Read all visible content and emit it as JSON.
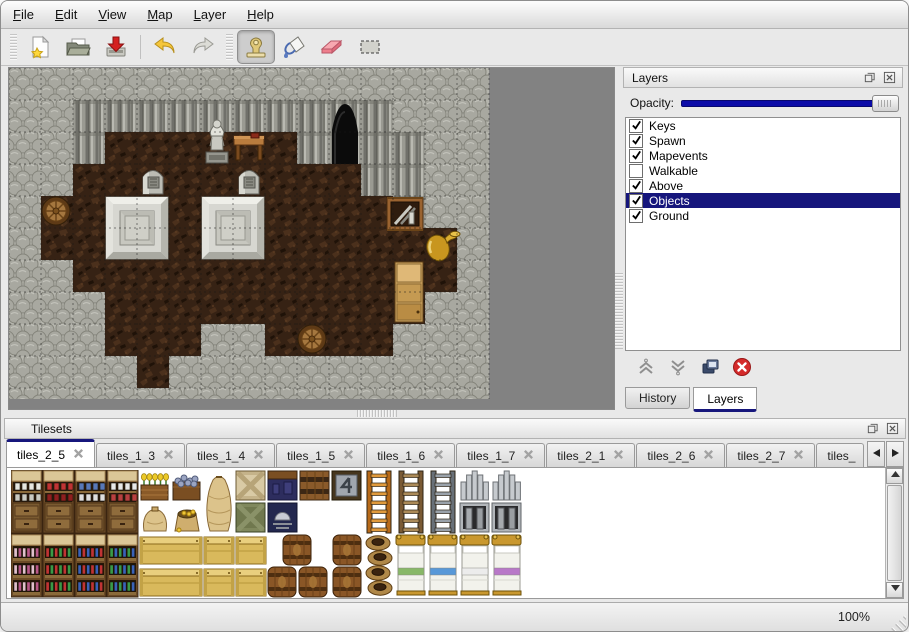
{
  "menubar": {
    "items": [
      {
        "label": "File"
      },
      {
        "label": "Edit"
      },
      {
        "label": "View"
      },
      {
        "label": "Map"
      },
      {
        "label": "Layer"
      },
      {
        "label": "Help"
      }
    ]
  },
  "toolbar": {
    "groups": [
      {
        "buttons": [
          {
            "name": "new",
            "icon": "new-file-icon"
          },
          {
            "name": "open",
            "icon": "open-folder-icon"
          },
          {
            "name": "save",
            "icon": "save-icon"
          }
        ]
      },
      {
        "buttons": [
          {
            "name": "undo",
            "icon": "undo-icon"
          },
          {
            "name": "redo",
            "icon": "redo-icon"
          }
        ]
      },
      {
        "buttons": [
          {
            "name": "stamp-tool",
            "icon": "stamp-icon",
            "selected": true
          },
          {
            "name": "fill-tool",
            "icon": "fill-icon"
          },
          {
            "name": "eraser-tool",
            "icon": "eraser-icon"
          },
          {
            "name": "select-tool",
            "icon": "select-icon"
          }
        ]
      }
    ]
  },
  "map": {
    "tile_size": 32,
    "grid": [
      "RRRRRRRRRRRRRRR",
      "RRWWWWWWWWWWRRR",
      "RRWFFFFFFWWWWRR",
      "RRFFFFFFFFFWWRR",
      "RFFFFFFFFFFFWRR",
      "RFFFFFFFFFFFFFR",
      "RRFFFFFFFFFFFFR",
      "RRRFFFFFFFFFFRR",
      "RRRFFFRRFFFFRRR",
      "RRRRFRRRRRRRRRR",
      "RRRRRRRRRRRRRRR"
    ],
    "objects": [
      {
        "type": "cave-door",
        "col": 10,
        "row": 1
      },
      {
        "type": "statue",
        "col": 6,
        "row": 1
      },
      {
        "type": "table",
        "col": 7,
        "row": 2
      },
      {
        "type": "gravestone",
        "col": 4,
        "row": 3
      },
      {
        "type": "gravestone",
        "col": 7,
        "row": 3
      },
      {
        "type": "pedestal",
        "col": 3,
        "row": 4
      },
      {
        "type": "pedestal",
        "col": 6,
        "row": 4
      },
      {
        "type": "barrel",
        "col": 1,
        "row": 4
      },
      {
        "type": "crate-weapons",
        "col": 12,
        "row": 4,
        "dx": -6
      },
      {
        "type": "gold-jug",
        "col": 13,
        "row": 5
      },
      {
        "type": "cabinet",
        "col": 12,
        "row": 6
      },
      {
        "type": "barrel",
        "col": 9,
        "row": 8
      }
    ]
  },
  "layers_panel": {
    "title": "Layers",
    "opacity_label": "Opacity:",
    "opacity_value": 100,
    "layers": [
      {
        "label": "Keys",
        "checked": true
      },
      {
        "label": "Spawn",
        "checked": true
      },
      {
        "label": "Mapevents",
        "checked": true
      },
      {
        "label": "Walkable",
        "checked": false
      },
      {
        "label": "Above",
        "checked": true
      },
      {
        "label": "Objects",
        "checked": true,
        "selected": true
      },
      {
        "label": "Ground",
        "checked": true
      }
    ],
    "buttons": [
      {
        "name": "raise-layer",
        "icon": "raise-icon"
      },
      {
        "name": "lower-layer",
        "icon": "lower-icon"
      },
      {
        "name": "duplicate-layer",
        "icon": "duplicate-icon"
      },
      {
        "name": "delete-layer",
        "icon": "delete-icon"
      }
    ],
    "tabs": [
      {
        "label": "History",
        "active": false
      },
      {
        "label": "Layers",
        "active": true
      }
    ]
  },
  "tilesets_panel": {
    "title": "Tilesets",
    "tabs": [
      {
        "label": "tiles_2_5",
        "active": true
      },
      {
        "label": "tiles_1_3"
      },
      {
        "label": "tiles_1_4"
      },
      {
        "label": "tiles_1_5"
      },
      {
        "label": "tiles_1_6"
      },
      {
        "label": "tiles_1_7"
      },
      {
        "label": "tiles_2_1"
      },
      {
        "label": "tiles_2_6"
      },
      {
        "label": "tiles_2_7"
      },
      {
        "label": "tiles_",
        "truncated": true
      }
    ],
    "tiles": [
      {
        "kind": "shelf",
        "col": 0,
        "row": 0,
        "accent": "#e6e6e0",
        "accent2": "#c9c9c1"
      },
      {
        "kind": "shelf",
        "col": 1,
        "row": 0,
        "accent": "#c03434",
        "accent2": "#8e1f1f"
      },
      {
        "kind": "shelf",
        "col": 2,
        "row": 0,
        "accent": "#5878b8",
        "accent2": "#dedede"
      },
      {
        "kind": "shelf",
        "col": 3,
        "row": 0,
        "accent": "#e8e8e8",
        "accent2": "#b84040"
      },
      {
        "kind": "bookshelf",
        "col": 0,
        "row": 2,
        "accent": "#e0c0cc",
        "accent2": "#b85888"
      },
      {
        "kind": "bookshelf",
        "col": 1,
        "row": 2,
        "accent": "#c03434",
        "accent2": "#3a9a48"
      },
      {
        "kind": "bookshelf",
        "col": 2,
        "row": 2,
        "accent": "#3a62b8",
        "accent2": "#c03434"
      },
      {
        "kind": "bookshelf",
        "col": 3,
        "row": 2,
        "accent": "#3a9a48",
        "accent2": "#3a62b8"
      },
      {
        "kind": "planter",
        "col": 4,
        "row": 0
      },
      {
        "kind": "ore-crate",
        "col": 5,
        "row": 0
      },
      {
        "kind": "sack-tall",
        "col": 6,
        "row": 0
      },
      {
        "kind": "crate-x-light",
        "col": 7,
        "row": 0
      },
      {
        "kind": "crate-dark-blue",
        "col": 8,
        "row": 0
      },
      {
        "kind": "crate-banded",
        "col": 9,
        "row": 0
      },
      {
        "kind": "crate-metal",
        "col": 10,
        "row": 0
      },
      {
        "kind": "ladder",
        "col": 11,
        "row": 0,
        "accent": "#b86a18",
        "accent2": "#e09a3c"
      },
      {
        "kind": "ladder",
        "col": 12,
        "row": 0,
        "accent": "#7a5a34",
        "accent2": "#ab8a58"
      },
      {
        "kind": "ladder",
        "col": 13,
        "row": 0,
        "accent": "#687078",
        "accent2": "#9aa2aa"
      },
      {
        "kind": "gate",
        "col": 14,
        "row": 0
      },
      {
        "kind": "gate",
        "col": 15,
        "row": 0
      },
      {
        "kind": "sack",
        "col": 4,
        "row": 1
      },
      {
        "kind": "sack-gold",
        "col": 5,
        "row": 1
      },
      {
        "kind": "crate-x-dark",
        "col": 7,
        "row": 1
      },
      {
        "kind": "crate-armor",
        "col": 8,
        "row": 1
      },
      {
        "kind": "crate-wide",
        "col": 4,
        "row": 2
      },
      {
        "kind": "crate",
        "col": 6,
        "row": 2
      },
      {
        "kind": "crate",
        "col": 7,
        "row": 2
      },
      {
        "kind": "crate-wide",
        "col": 4,
        "row": 3
      },
      {
        "kind": "crate",
        "col": 6,
        "row": 3
      },
      {
        "kind": "crate",
        "col": 7,
        "row": 3
      },
      {
        "kind": "barrel-cluster",
        "col": 8,
        "row": 2
      },
      {
        "kind": "barrel-front",
        "col": 10,
        "row": 2
      },
      {
        "kind": "barrel-front",
        "col": 10,
        "row": 3
      },
      {
        "kind": "pots",
        "col": 11,
        "row": 2
      },
      {
        "kind": "bed",
        "col": 12,
        "row": 2,
        "accent": "#88b868"
      },
      {
        "kind": "bed",
        "col": 13,
        "row": 2,
        "accent": "#5898d8"
      },
      {
        "kind": "bed",
        "col": 14,
        "row": 2,
        "accent": "#ececec"
      },
      {
        "kind": "bed",
        "col": 15,
        "row": 2,
        "accent": "#b878c8"
      }
    ]
  },
  "statusbar": {
    "zoom": "100%"
  },
  "colors": {
    "selection": "#16167c",
    "slider": "#0b0ba8",
    "canvas_gray": "#828282"
  }
}
